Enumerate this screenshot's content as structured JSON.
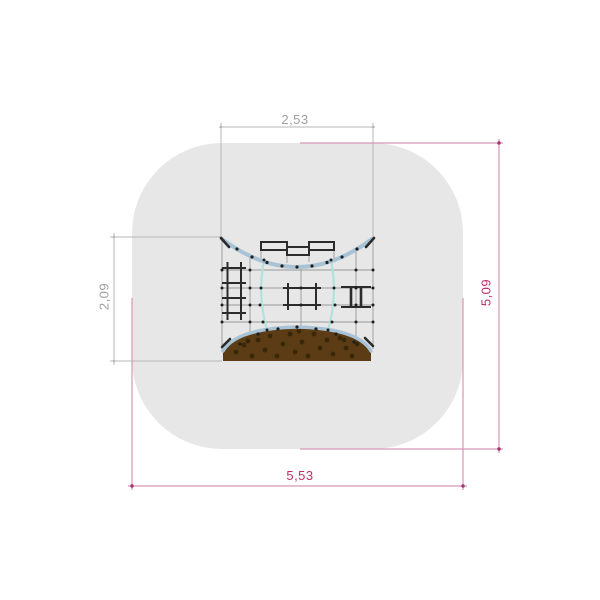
{
  "page": {
    "background": "#ffffff",
    "content": "playground-equipment-plan-view-with-safety-zone"
  },
  "drawing": {
    "dimension_labels": {
      "equipment_width": "2,53",
      "equipment_depth": "2,09",
      "safety_zone_width": "5,53",
      "safety_zone_length": "5,09"
    },
    "colors": {
      "safety_zone_fill": "#e7e7e7",
      "dim_gray_line": "#b7b7b7",
      "dim_gray_text": "#9e9e9e",
      "dim_magenta_line": "#d897ba",
      "dim_magenta_dot": "#a53172",
      "dim_magenta_text": "#bd2e68",
      "net_frame_blue": "#a9c3d6",
      "net_rope_cyan": "#b2e2dc",
      "rope_gray": "#9a9a9a",
      "structure_black": "#2b2b2b",
      "wall_brown": "#5b3c15",
      "wall_spot": "#3a2708",
      "connector_black": "#1f1f1f"
    }
  }
}
